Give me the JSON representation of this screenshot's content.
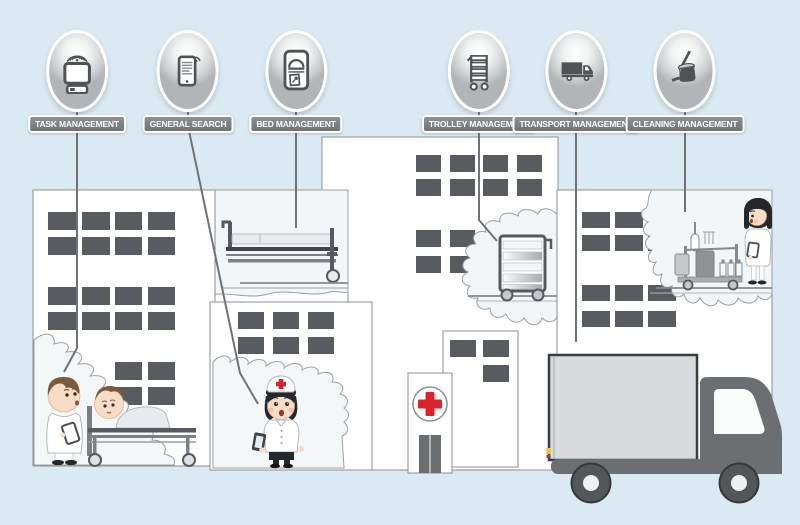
{
  "badges": [
    {
      "label": "TASK MANAGEMENT",
      "icon": "task-management-icon"
    },
    {
      "label": "GENERAL SEARCH",
      "icon": "general-search-icon"
    },
    {
      "label": "BED MANAGEMENT",
      "icon": "bed-management-icon"
    },
    {
      "label": "TROLLEY MANAGEMENT",
      "icon": "trolley-management-icon"
    },
    {
      "label": "TRANSPORT MANAGEMENT",
      "icon": "transport-management-icon"
    },
    {
      "label": "CLEANING MANAGEMENT",
      "icon": "cleaning-management-icon"
    }
  ],
  "colors": {
    "background": "#dbe9f2",
    "cross_red": "#d8232a",
    "label_pill": "#7c8083",
    "window": "#585c60",
    "icon_gray": "#4f5356"
  }
}
